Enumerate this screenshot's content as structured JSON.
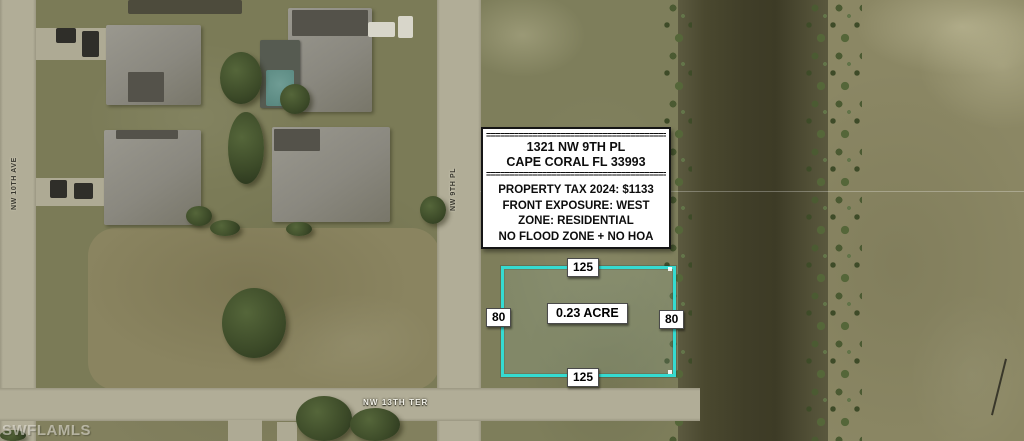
{
  "watermark": "SWFLAMLS",
  "info_box": {
    "separator_top": "==========================================",
    "address_line1": "1321 NW 9TH PL",
    "address_line2": "CAPE CORAL FL 33993",
    "separator_mid": "==========================================",
    "tax_line": "PROPERTY TAX 2024: $1133",
    "exposure_line": "FRONT EXPOSURE: WEST",
    "zone_line": "ZONE: RESIDENTIAL",
    "flood_line": "NO FLOOD ZONE + NO HOA"
  },
  "parcel": {
    "top_dimension": "125",
    "bottom_dimension": "125",
    "left_dimension": "80",
    "right_dimension": "80",
    "area_label": "0.23 ACRE",
    "outline_color": "#35dbd1"
  },
  "streets": {
    "left_avenue": "NW 10TH AVE",
    "middle_place": "NW 9TH PL",
    "bottom_terrace": "NW 13TH TER"
  }
}
